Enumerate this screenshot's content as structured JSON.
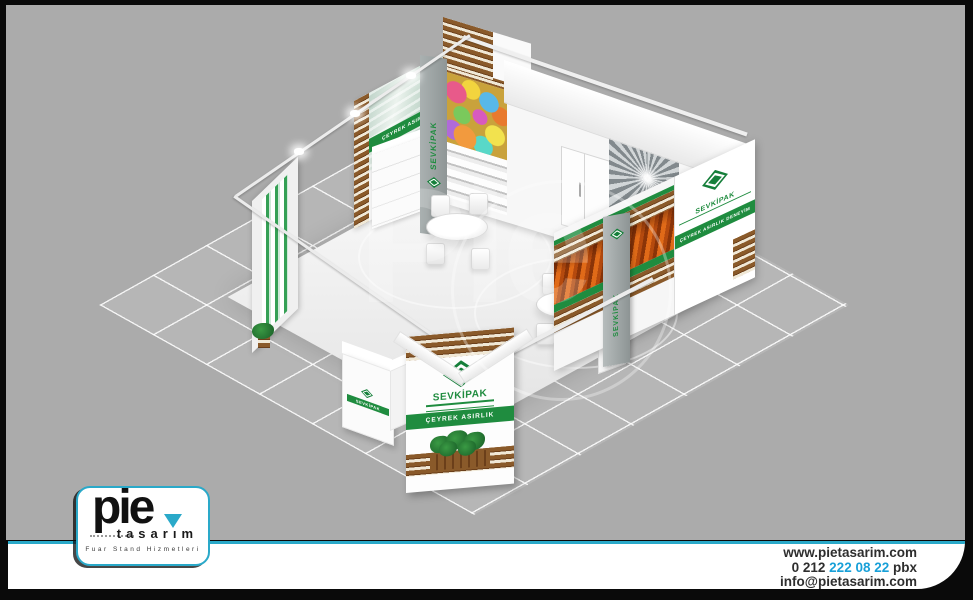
{
  "colors": {
    "background_gray": "#ababab",
    "frame_black": "#0a0a0a",
    "accent_teal": "#2aa9c9",
    "phone_blue": "#18a0d8",
    "brand_green": "#1f8c3f",
    "wood_brown": "#8a5a2a"
  },
  "stand": {
    "exhibitor_name": "SEVKİPAK",
    "slogan_banner": "ÇEYREK ASIRLIK DENEYİM",
    "watermark_text": "Pie"
  },
  "footer": {
    "logo_wordmark": "pie",
    "logo_subtitle": "tasarım",
    "logo_tagline": "Fuar Stand Hizmetleri",
    "website": "www.pietasarim.com",
    "phone_prefix": "0 212 ",
    "phone_number": "222 08 22",
    "phone_suffix": " pbx",
    "email": "info@pietasarim.com"
  }
}
